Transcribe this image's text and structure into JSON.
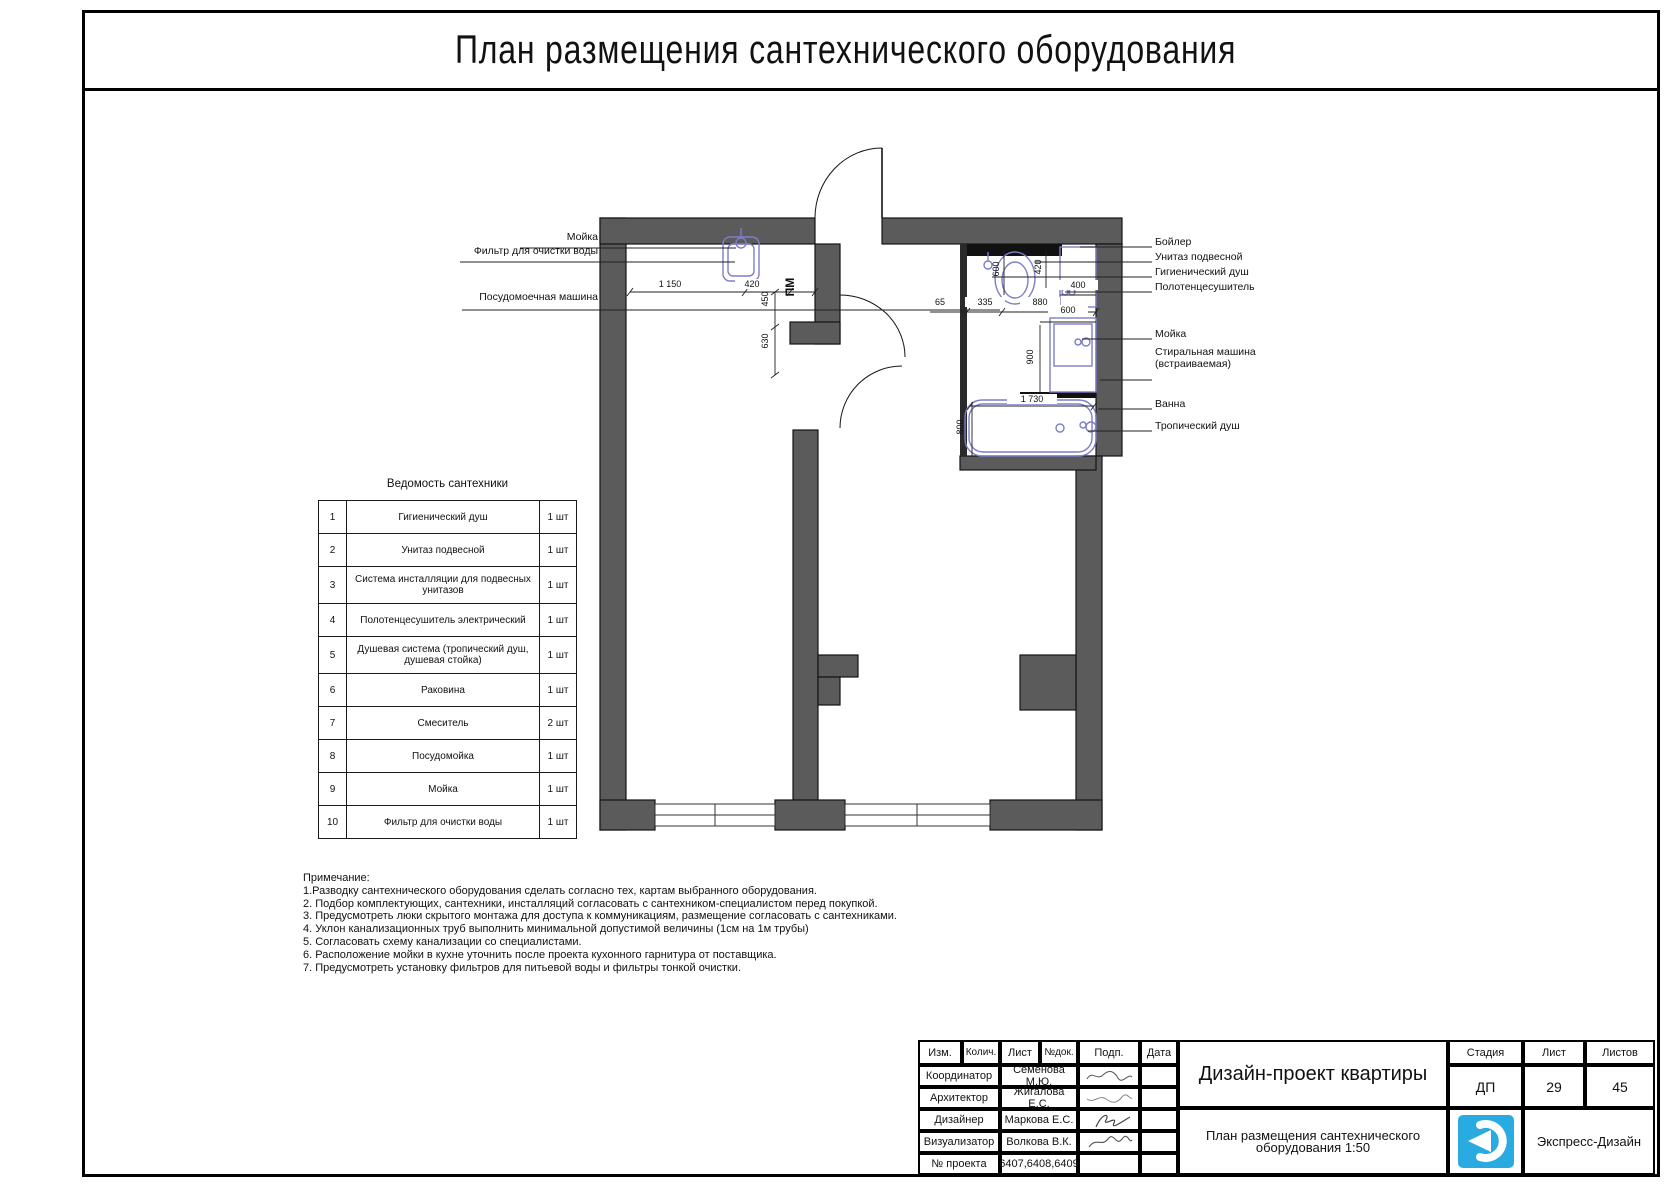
{
  "page": {
    "title": "План размещения сантехнического оборудования"
  },
  "plan": {
    "pm_label": "ПМ",
    "left_callouts": [
      "Мойка",
      "Фильтр для очистки воды",
      "Посудомоечная машина"
    ],
    "right_callouts": [
      "Бойлер",
      "Унитаз подвесной",
      "Гигиенический душ",
      "Полотенцесушитель",
      "Мойка",
      "Стиральная машина",
      "(встраиваемая)",
      "Ванна",
      "Тропический душ"
    ],
    "dims": {
      "k_1150": "1 150",
      "k_420": "420",
      "k_450": "450",
      "k_630": "630",
      "b_600_v": "600",
      "b_420_v": "420",
      "b_400": "400",
      "b_65": "65",
      "b_335": "335",
      "b_880": "880",
      "b_600_w": "600",
      "b_900_v": "900",
      "b_1730": "1 730",
      "b_800_v": "800"
    }
  },
  "fixtures_table": {
    "title": "Ведомость сантехники",
    "rows": [
      {
        "num": "1",
        "name": "Гигиенический душ",
        "qty": "1 шт"
      },
      {
        "num": "2",
        "name": "Унитаз подвесной",
        "qty": "1 шт"
      },
      {
        "num": "3",
        "name": "Система инсталляции для подвесных унитазов",
        "qty": "1 шт"
      },
      {
        "num": "4",
        "name": "Полотенцесушитель электрический",
        "qty": "1 шт"
      },
      {
        "num": "5",
        "name": "Душевая система (тропический душ, душевая стойка)",
        "qty": "1 шт"
      },
      {
        "num": "6",
        "name": "Раковина",
        "qty": "1 шт"
      },
      {
        "num": "7",
        "name": "Смеситель",
        "qty": "2 шт"
      },
      {
        "num": "8",
        "name": "Посудомойка",
        "qty": "1 шт"
      },
      {
        "num": "9",
        "name": "Мойка",
        "qty": "1 шт"
      },
      {
        "num": "10",
        "name": "Фильтр для очистки воды",
        "qty": "1 шт"
      }
    ]
  },
  "notes": {
    "header": "Примечание:",
    "items": [
      "1.Разводку сантехнического оборудования сделать согласно тех, картам выбранного оборудования.",
      "2. Подбор комплектующих, сантехники, инсталляций согласовать с сантехником-специалистом перед покупкой.",
      "3. Предусмотреть люки скрытого монтажа для доступа к коммуникациям, размещение согласовать с сантехниками.",
      "4. Уклон канализационных труб выполнить минимальной допустимой величины (1см на 1м трубы)",
      "5. Согласовать схему канализации со специалистами.",
      "6. Расположение мойки в кухне уточнить после проекта кухонного гарнитура от поставщика.",
      "7. Предусмотреть установку фильтров для питьевой воды и фильтры тонкой очистки."
    ]
  },
  "title_block": {
    "cols": [
      "Изм.",
      "Колич.",
      "Лист",
      "№док.",
      "Подп.",
      "Дата"
    ],
    "rows": [
      {
        "role": "Координатор",
        "name": "Семенова М.Ю."
      },
      {
        "role": "Архитектор",
        "name": "Жигалова Е.С."
      },
      {
        "role": "Дизайнер",
        "name": "Маркова Е.С."
      },
      {
        "role": "Визуализатор",
        "name": "Волкова В.К."
      },
      {
        "role": "№ проекта",
        "name": "6407,6408,6409"
      }
    ],
    "project_title": "Дизайн-проект квартиры",
    "sheet_title_line1": "План размещения сантехнического",
    "sheet_title_line2": "оборудования 1:50",
    "stage_label": "Стадия",
    "stage_value": "ДП",
    "sheet_label": "Лист",
    "sheet_value": "29",
    "sheets_label": "Листов",
    "sheets_value": "45",
    "company": "Экспресс-Дизайн"
  },
  "colors": {
    "wall": "#5b5b5b",
    "fixture": "#7d7dc9",
    "pm_blue": "#2a2ad0",
    "logo_blue": "#29abe2"
  }
}
